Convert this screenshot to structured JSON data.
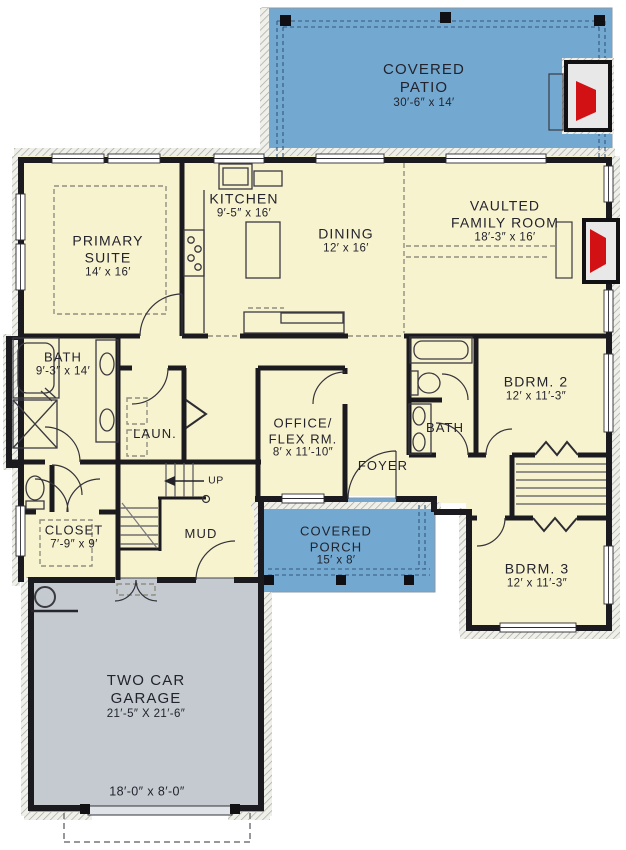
{
  "rooms": {
    "patio": {
      "line1": "COVERED",
      "line2": "PATIO",
      "dims": "30′-6″ x 14′"
    },
    "kitchen": {
      "name": "KITCHEN",
      "dims": "9′-5″ x 16′"
    },
    "dining": {
      "name": "DINING",
      "dims": "12′ x 16′"
    },
    "family": {
      "line1": "VAULTED",
      "line2": "FAMILY ROOM",
      "dims": "18′-3″ x 16′"
    },
    "primary": {
      "line1": "PRIMARY",
      "line2": "SUITE",
      "dims": "14′ x 16′"
    },
    "bath1": {
      "name": "BATH",
      "dims": "9′-3″ x 14′"
    },
    "laundry": {
      "name": "LAUN."
    },
    "stairs": {
      "label": "UP"
    },
    "office": {
      "line1": "OFFICE/",
      "line2": "FLEX RM.",
      "dims": "8′ x 11′-10″"
    },
    "foyer": {
      "name": "FOYER"
    },
    "bath2": {
      "name": "BATH"
    },
    "bdrm2": {
      "name": "BDRM. 2",
      "dims": "12′ x 11′-3″"
    },
    "closet": {
      "name": "CLOSET",
      "dims": "7′-9″ x 9′"
    },
    "mud": {
      "name": "MUD"
    },
    "porch": {
      "line1": "COVERED",
      "line2": "PORCH",
      "dims": "15′ x 8′"
    },
    "bdrm3": {
      "name": "BDRM. 3",
      "dims": "12′ x 11′-3″"
    },
    "garage": {
      "line1": "TWO CAR",
      "line2": "GARAGE",
      "dims": "21′-5″ X 21′-6″",
      "door_dims": "18′-0″ x 8′-0″"
    }
  },
  "colors": {
    "room_fill": "#f8f3cf",
    "outdoor_blue": "#73a9d1",
    "garage_gray": "#c4cad0",
    "wall": "#1b1b1f",
    "fireplace_red": "#d21114"
  }
}
